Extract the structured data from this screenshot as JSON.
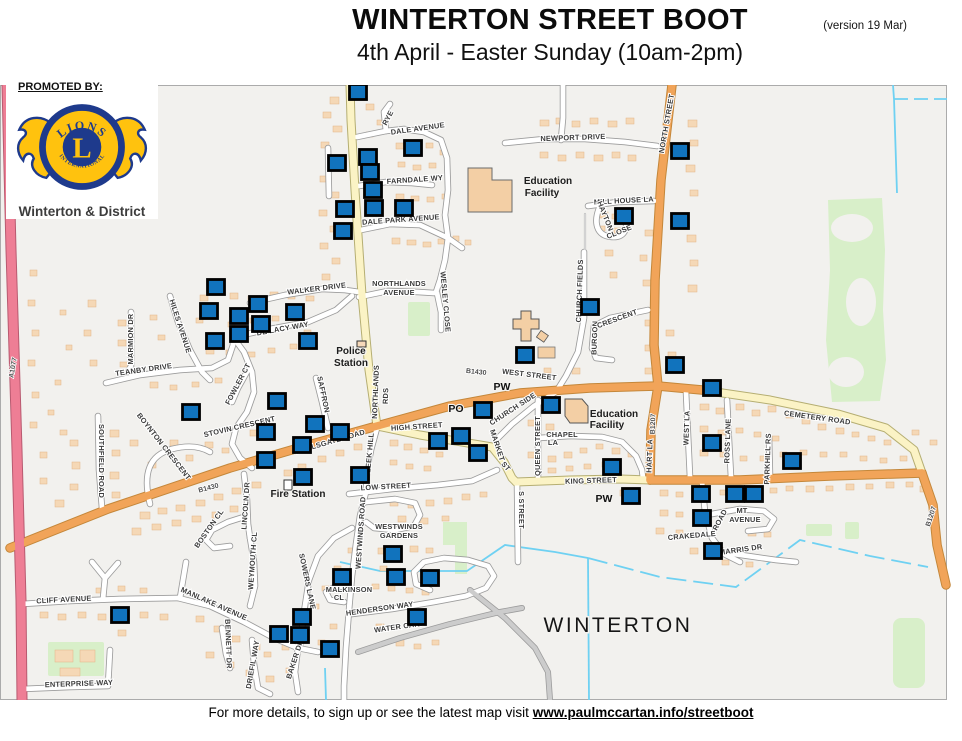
{
  "header": {
    "title": "WINTERTON STREET BOOT",
    "version": "(version 19 Mar)",
    "subtitle": "4th April - Easter Sunday  (10am-2pm)"
  },
  "promoter": {
    "label": "PROMOTED BY:",
    "logo_top": "LIONS",
    "logo_center": "L",
    "logo_bottom": "INTERNATIONAL",
    "name": "Winterton & District"
  },
  "footer": {
    "text": "For more details, to sign up or see the latest map visit ",
    "link": "www.paulmccartan.info/streetboot"
  },
  "map": {
    "town_label": "WINTERTON",
    "marker_color": "#1173BD",
    "lions_blue": "#1E3A8C",
    "lions_gold": "#FFC20E",
    "labels": [
      {
        "t": "DALE AVENUE",
        "x": 418,
        "y": 131,
        "r": -8
      },
      {
        "t": "RYE",
        "x": 390,
        "y": 119,
        "r": -62
      },
      {
        "t": "FARNDALE WY",
        "x": 415,
        "y": 182,
        "r": -4
      },
      {
        "t": "DALE PARK AVENUE",
        "x": 401,
        "y": 222,
        "r": -4
      },
      {
        "t": "NORTHLANDS",
        "x": 399,
        "y": 286,
        "r": 0
      },
      {
        "t": "AVENUE",
        "x": 399,
        "y": 295,
        "r": 0
      },
      {
        "t": "WESLEY CLOSE",
        "x": 443,
        "y": 302,
        "r": 85
      },
      {
        "t": "NEWPORT DRIVE",
        "x": 573,
        "y": 140,
        "r": -2
      },
      {
        "t": "NORTH STREET",
        "x": 669,
        "y": 124,
        "r": -80
      },
      {
        "t": "MILL HOUSE LA",
        "x": 624,
        "y": 203,
        "r": -3
      },
      {
        "t": "HAYTON",
        "x": 603,
        "y": 217,
        "r": 68
      },
      {
        "t": "CLOSE",
        "x": 620,
        "y": 234,
        "r": -22
      },
      {
        "t": "WALKER DRIVE",
        "x": 317,
        "y": 291,
        "r": -7
      },
      {
        "t": "DE LACY WAY",
        "x": 283,
        "y": 331,
        "r": -10
      },
      {
        "t": "HILES AVENUE",
        "x": 178,
        "y": 327,
        "r": 72
      },
      {
        "t": "MARMION DR",
        "x": 133,
        "y": 339,
        "r": -90
      },
      {
        "t": "TEANBY DRIVE",
        "x": 144,
        "y": 372,
        "r": -8
      },
      {
        "t": "FOWLER CT",
        "x": 240,
        "y": 385,
        "r": -62
      },
      {
        "t": "STOVIN CRESCENT",
        "x": 240,
        "y": 429,
        "r": -13
      },
      {
        "t": "BOYNTON CRESCENT",
        "x": 162,
        "y": 448,
        "r": 52
      },
      {
        "t": "SOUTHFIELD ROAD",
        "x": 99,
        "y": 461,
        "r": 90
      },
      {
        "t": "SAFFRON",
        "x": 321,
        "y": 395,
        "r": 78
      },
      {
        "t": "EARLSGATE ROAD",
        "x": 331,
        "y": 444,
        "r": -16
      },
      {
        "t": "WEST STREET",
        "x": 529,
        "y": 377,
        "r": 7
      },
      {
        "t": "HIGH STREET",
        "x": 417,
        "y": 429,
        "r": -4
      },
      {
        "t": "LOW STREET",
        "x": 386,
        "y": 489,
        "r": -3
      },
      {
        "t": "NORTHLANDS",
        "x": 378,
        "y": 392,
        "r": -88
      },
      {
        "t": "RDS",
        "x": 388,
        "y": 396,
        "r": -88
      },
      {
        "t": "LEEK HILL",
        "x": 372,
        "y": 453,
        "r": -85
      },
      {
        "t": "MARKET",
        "x": 495,
        "y": 446,
        "r": 72
      },
      {
        "t": "ST",
        "x": 504,
        "y": 468,
        "r": 50
      },
      {
        "t": "CHURCH SIDE",
        "x": 514,
        "y": 411,
        "r": -33
      },
      {
        "t": "CHAPEL",
        "x": 562,
        "y": 437,
        "r": 0
      },
      {
        "t": "LA",
        "x": 553,
        "y": 445,
        "r": 0
      },
      {
        "t": "QUEEN STREET",
        "x": 540,
        "y": 446,
        "r": -90
      },
      {
        "t": "S STREET",
        "x": 519,
        "y": 510,
        "r": 90
      },
      {
        "t": "CHURCH FIELDS",
        "x": 582,
        "y": 291,
        "r": -88
      },
      {
        "t": "BURGON",
        "x": 597,
        "y": 338,
        "r": -88
      },
      {
        "t": "CRESCENT",
        "x": 618,
        "y": 321,
        "r": -20
      },
      {
        "t": "CEMETERY ROAD",
        "x": 817,
        "y": 420,
        "r": 8
      },
      {
        "t": "KING STREET",
        "x": 591,
        "y": 483,
        "r": -2
      },
      {
        "t": "HART LA",
        "x": 652,
        "y": 456,
        "r": -88
      },
      {
        "t": "WEST LA",
        "x": 689,
        "y": 428,
        "r": -88
      },
      {
        "t": "ROSS LANE",
        "x": 730,
        "y": 441,
        "r": -88
      },
      {
        "t": "PARKHILL RS",
        "x": 770,
        "y": 459,
        "r": -88
      },
      {
        "t": "MT",
        "x": 742,
        "y": 513,
        "r": 0
      },
      {
        "t": "AVENUE",
        "x": 745,
        "y": 522,
        "r": 0
      },
      {
        "t": "CRAKEDALE",
        "x": 692,
        "y": 538,
        "r": -5
      },
      {
        "t": "ROAD",
        "x": 722,
        "y": 521,
        "r": -62
      },
      {
        "t": "MARRIS DR",
        "x": 741,
        "y": 552,
        "r": -8
      },
      {
        "t": "WESTWINDS",
        "x": 399,
        "y": 529,
        "r": 0
      },
      {
        "t": "GARDENS",
        "x": 399,
        "y": 538,
        "r": 0
      },
      {
        "t": "WESTWINDS ROAD",
        "x": 363,
        "y": 533,
        "r": -86
      },
      {
        "t": "MALKINSON",
        "x": 349,
        "y": 592,
        "r": 0
      },
      {
        "t": "CL",
        "x": 339,
        "y": 600,
        "r": 0
      },
      {
        "t": "HENDERSON WAY",
        "x": 380,
        "y": 611,
        "r": -8
      },
      {
        "t": "WATER CARR",
        "x": 400,
        "y": 629,
        "r": -8
      },
      {
        "t": "MANLAKE AVENUE",
        "x": 213,
        "y": 606,
        "r": 24
      },
      {
        "t": "CLIFF AVENUE",
        "x": 64,
        "y": 602,
        "r": -3
      },
      {
        "t": "ENTERPRISE WAY",
        "x": 79,
        "y": 686,
        "r": -2
      },
      {
        "t": "BENNETT DR",
        "x": 226,
        "y": 644,
        "r": 88
      },
      {
        "t": "DRIEFIL WAY",
        "x": 255,
        "y": 665,
        "r": -80
      },
      {
        "t": "BAKER DR",
        "x": 297,
        "y": 660,
        "r": -72
      },
      {
        "t": "SOWERS LANE",
        "x": 305,
        "y": 582,
        "r": 78
      },
      {
        "t": "LINCOLN DR",
        "x": 248,
        "y": 506,
        "r": -86
      },
      {
        "t": "BOSTON CL",
        "x": 211,
        "y": 530,
        "r": -55
      },
      {
        "t": "WEYMOUTH CL",
        "x": 255,
        "y": 561,
        "r": -86
      },
      {
        "t": "B1430",
        "x": 209,
        "y": 490,
        "r": -15,
        "k": "ref"
      },
      {
        "t": "B1430",
        "x": 476,
        "y": 374,
        "r": 6,
        "k": "ref"
      },
      {
        "t": "B1207",
        "x": 655,
        "y": 424,
        "r": -88,
        "k": "ref"
      },
      {
        "t": "B1207",
        "x": 933,
        "y": 517,
        "r": -72,
        "k": "ref"
      },
      {
        "t": "A1077",
        "x": 15,
        "y": 368,
        "r": -80,
        "k": "ref"
      },
      {
        "t": "Police",
        "x": 351,
        "y": 354,
        "r": 0,
        "k": "poi"
      },
      {
        "t": "Station",
        "x": 351,
        "y": 366,
        "r": 0,
        "k": "poi"
      },
      {
        "t": "Fire Station",
        "x": 298,
        "y": 497,
        "r": 0,
        "k": "poi"
      },
      {
        "t": "Education",
        "x": 548,
        "y": 184,
        "r": 0,
        "k": "poi"
      },
      {
        "t": "Facility",
        "x": 542,
        "y": 196,
        "r": 0,
        "k": "poi"
      },
      {
        "t": "Education",
        "x": 614,
        "y": 417,
        "r": 0,
        "k": "poi"
      },
      {
        "t": "Facility",
        "x": 607,
        "y": 428,
        "r": 0,
        "k": "poi"
      },
      {
        "t": "PO",
        "x": 456,
        "y": 412,
        "r": 0,
        "k": "pw"
      },
      {
        "t": "PW",
        "x": 502,
        "y": 390,
        "r": 0,
        "k": "pw"
      },
      {
        "t": "PW",
        "x": 604,
        "y": 502,
        "r": 0,
        "k": "pw"
      },
      {
        "t": "WINTERTON",
        "x": 618,
        "y": 632,
        "r": 0,
        "k": "town"
      }
    ],
    "markers": [
      [
        358,
        92
      ],
      [
        337,
        163
      ],
      [
        368,
        157
      ],
      [
        413,
        148
      ],
      [
        370,
        172
      ],
      [
        373,
        190
      ],
      [
        374,
        208
      ],
      [
        345,
        209
      ],
      [
        404,
        208
      ],
      [
        343,
        231
      ],
      [
        680,
        151
      ],
      [
        624,
        216
      ],
      [
        680,
        221
      ],
      [
        216,
        287
      ],
      [
        209,
        311
      ],
      [
        258,
        304
      ],
      [
        239,
        316
      ],
      [
        261,
        324
      ],
      [
        295,
        312
      ],
      [
        239,
        334
      ],
      [
        215,
        341
      ],
      [
        308,
        341
      ],
      [
        191,
        412
      ],
      [
        277,
        401
      ],
      [
        315,
        424
      ],
      [
        340,
        432
      ],
      [
        266,
        432
      ],
      [
        302,
        445
      ],
      [
        266,
        460
      ],
      [
        303,
        477
      ],
      [
        438,
        441
      ],
      [
        461,
        436
      ],
      [
        478,
        453
      ],
      [
        360,
        475
      ],
      [
        483,
        410
      ],
      [
        551,
        405
      ],
      [
        525,
        355
      ],
      [
        590,
        307
      ],
      [
        675,
        365
      ],
      [
        712,
        388
      ],
      [
        712,
        443
      ],
      [
        612,
        467
      ],
      [
        792,
        461
      ],
      [
        631,
        496
      ],
      [
        701,
        494
      ],
      [
        735,
        494
      ],
      [
        754,
        494
      ],
      [
        702,
        518
      ],
      [
        713,
        551
      ],
      [
        393,
        554
      ],
      [
        342,
        577
      ],
      [
        396,
        577
      ],
      [
        430,
        578
      ],
      [
        417,
        617
      ],
      [
        302,
        617
      ],
      [
        279,
        634
      ],
      [
        300,
        635
      ],
      [
        330,
        649
      ],
      [
        120,
        615
      ]
    ]
  }
}
